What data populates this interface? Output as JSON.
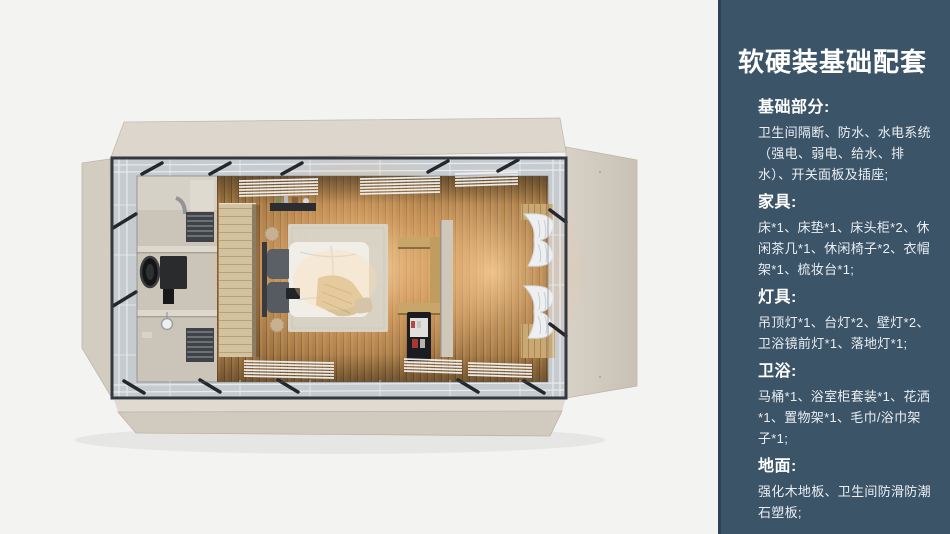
{
  "panel": {
    "title": "软硬装基础配套",
    "sections": [
      {
        "heading": "基础部分:",
        "body": "卫生间隔断、防水、水电系统（强电、弱电、给水、排水）、开关面板及插座;"
      },
      {
        "heading": "家具:",
        "body": "床*1、床垫*1、床头柜*2、休闲茶几*1、休闲椅子*2、衣帽架*1、梳妆台*1;"
      },
      {
        "heading": "灯具:",
        "body": "吊顶灯*1、台灯*2、壁灯*2、卫浴镜前灯*1、落地灯*1;"
      },
      {
        "heading": "卫浴:",
        "body": "马桶*1、浴室柜套装*1、花洒*1、置物架*1、毛巾/浴巾架子*1;"
      },
      {
        "heading": "地面:",
        "body": "强化木地板、卫生间防滑防潮石塑板;"
      }
    ]
  },
  "colors": {
    "panel_bg": "#3c5467",
    "panel_edge": "#2e4156",
    "page_bg": "#f3f4f2",
    "shell_beige": "#d6cfc5",
    "floor_wood": "#a57a45",
    "glow_warm": "#ffd9a4"
  }
}
